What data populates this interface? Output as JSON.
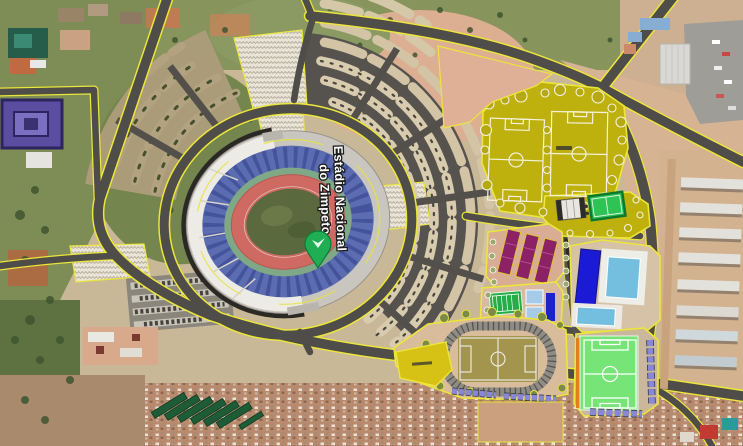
{
  "map": {
    "type": "satellite-map",
    "place_label": {
      "line1": "Estádio Nacional",
      "line2": "do Zimpeto"
    },
    "marker_color": "#1fae53",
    "palette": {
      "road_outline": "#f0e43c",
      "asphalt": "#4f4d49",
      "sports_zone_yellow": "#bfb10d",
      "stadium_track_red": "#cf6a63",
      "stadium_stand_blue": "#5b6cb0",
      "pool_dark_blue": "#1b1bd6",
      "pool_light_blue": "#74bfe0",
      "training_field_green": "#76e476",
      "court_purple": "#8c2166"
    }
  }
}
